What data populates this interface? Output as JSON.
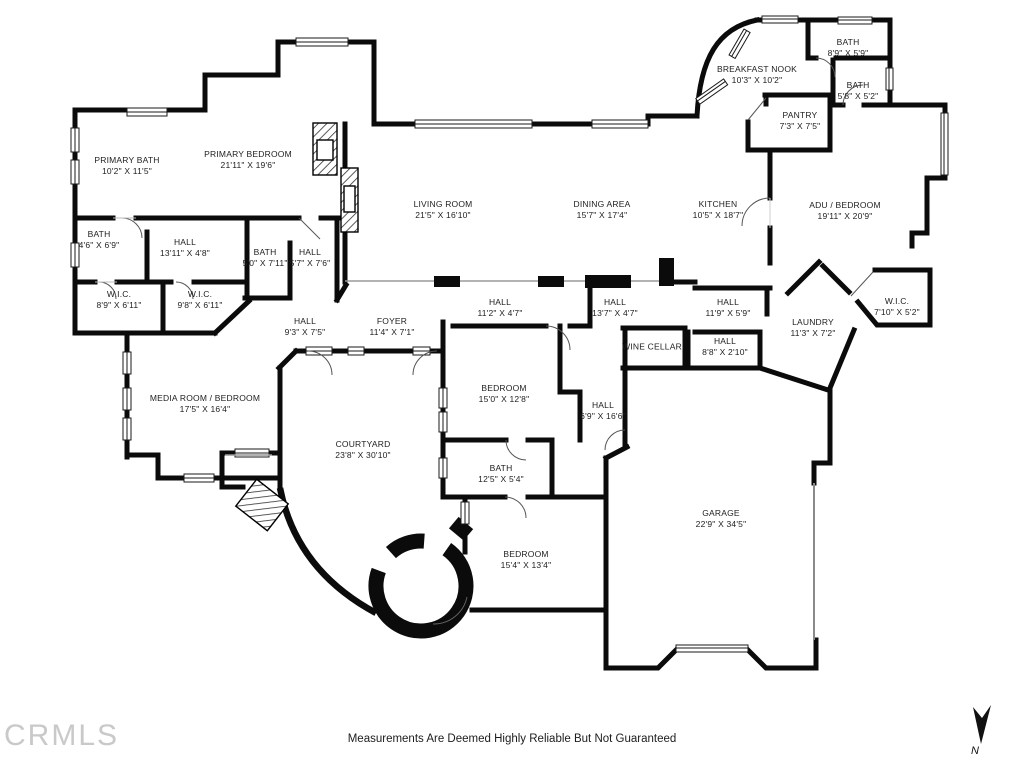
{
  "watermark": {
    "text": "CRMLS"
  },
  "footer": {
    "disclaimer": "Measurements Are Deemed Highly Reliable But Not Guaranteed"
  },
  "compass": {
    "label": "N"
  },
  "colors": {
    "wall": "#0b0b0b",
    "background": "#ffffff",
    "watermark_gray": "#c9c9c9",
    "label_text": "#1e1e1e"
  },
  "floorplan": {
    "rooms": [
      {
        "name": "PRIMARY BATH",
        "dims": "10'2\" X 11'5\"",
        "x": 127,
        "y": 166
      },
      {
        "name": "PRIMARY BEDROOM",
        "dims": "21'11\" X 19'6\"",
        "x": 248,
        "y": 160
      },
      {
        "name": "BREAKFAST NOOK",
        "dims": "10'3\" X 10'2\"",
        "x": 757,
        "y": 75
      },
      {
        "name": "BATH",
        "dims": "8'9\" X 5'9\"",
        "x": 848,
        "y": 48
      },
      {
        "name": "BATH",
        "dims": "5'8\" X 5'2\"",
        "x": 858,
        "y": 91
      },
      {
        "name": "PANTRY",
        "dims": "7'3\" X 7'5\"",
        "x": 800,
        "y": 121
      },
      {
        "name": "LIVING ROOM",
        "dims": "21'5\" X 16'10\"",
        "x": 443,
        "y": 210
      },
      {
        "name": "DINING AREA",
        "dims": "15'7\" X 17'4\"",
        "x": 602,
        "y": 210
      },
      {
        "name": "KITCHEN",
        "dims": "10'5\" X 18'7\"",
        "x": 718,
        "y": 210
      },
      {
        "name": "ADU / BEDROOM",
        "dims": "19'11\" X 20'9\"",
        "x": 845,
        "y": 211
      },
      {
        "name": "BATH",
        "dims": "4'6\" X 6'9\"",
        "x": 99,
        "y": 240
      },
      {
        "name": "HALL",
        "dims": "13'11\" X 4'8\"",
        "x": 185,
        "y": 248
      },
      {
        "name": "BATH",
        "dims": "5'0\" X 7'11\"",
        "x": 265,
        "y": 258
      },
      {
        "name": "HALL",
        "dims": "5'7\" X 7'6\"",
        "x": 310,
        "y": 258
      },
      {
        "name": "W.I.C.",
        "dims": "8'9\" X 6'11\"",
        "x": 119,
        "y": 300
      },
      {
        "name": "W.I.C.",
        "dims": "9'8\" X 6'11\"",
        "x": 200,
        "y": 300
      },
      {
        "name": "HALL",
        "dims": "9'3\" X 7'5\"",
        "x": 305,
        "y": 327
      },
      {
        "name": "FOYER",
        "dims": "11'4\" X 7'1\"",
        "x": 392,
        "y": 327
      },
      {
        "name": "HALL",
        "dims": "11'2\" X 4'7\"",
        "x": 500,
        "y": 308
      },
      {
        "name": "HALL",
        "dims": "13'7\" X 4'7\"",
        "x": 615,
        "y": 308
      },
      {
        "name": "HALL",
        "dims": "11'9\" X 5'9\"",
        "x": 728,
        "y": 308
      },
      {
        "name": "LAUNDRY",
        "dims": "11'3\" X 7'2\"",
        "x": 813,
        "y": 328
      },
      {
        "name": "W.I.C.",
        "dims": "7'10\" X 5'2\"",
        "x": 897,
        "y": 307
      },
      {
        "name": "WINE CELLAR",
        "dims": "",
        "x": 652,
        "y": 347
      },
      {
        "name": "HALL",
        "dims": "8'8\" X 2'10\"",
        "x": 725,
        "y": 347
      },
      {
        "name": "MEDIA ROOM / BEDROOM",
        "dims": "17'5\" X 16'4\"",
        "x": 205,
        "y": 404
      },
      {
        "name": "BEDROOM",
        "dims": "15'0\" X 12'8\"",
        "x": 504,
        "y": 394
      },
      {
        "name": "HALL",
        "dims": "6'9\" X 16'6\"",
        "x": 603,
        "y": 411
      },
      {
        "name": "COURTYARD",
        "dims": "23'8\" X 30'10\"",
        "x": 363,
        "y": 450
      },
      {
        "name": "BATH",
        "dims": "12'5\" X 5'4\"",
        "x": 501,
        "y": 474
      },
      {
        "name": "BEDROOM",
        "dims": "15'4\" X 13'4\"",
        "x": 526,
        "y": 560
      },
      {
        "name": "GARAGE",
        "dims": "22'9\" X 34'5\"",
        "x": 721,
        "y": 519
      }
    ]
  }
}
